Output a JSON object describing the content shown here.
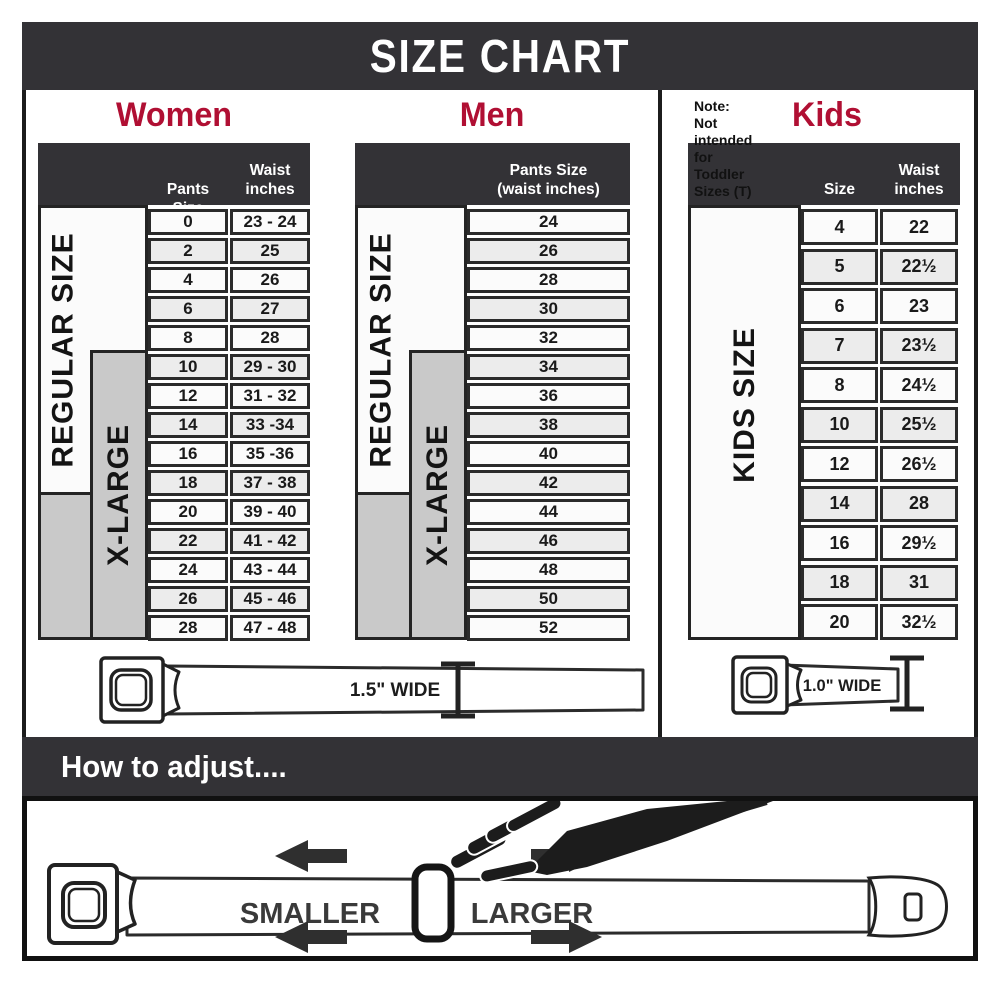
{
  "page": {
    "title": "SIZE CHART"
  },
  "colors": {
    "dark_band": "#333236",
    "accent_red": "#b00f33",
    "xlarge_gray": "#c9c9c9",
    "row_light": "#fbfbfb",
    "row_shaded": "#ececec",
    "border": "#2b2b2b"
  },
  "sections": {
    "women": {
      "title": "Women",
      "col1_header": "Pants Size",
      "col2_header_line1": "Waist",
      "col2_header_line2": "inches",
      "regular_label": "REGULAR SIZE",
      "xlarge_label": "X-LARGE",
      "rows": [
        {
          "size": "0",
          "waist": "23 - 24"
        },
        {
          "size": "2",
          "waist": "25"
        },
        {
          "size": "4",
          "waist": "26"
        },
        {
          "size": "6",
          "waist": "27"
        },
        {
          "size": "8",
          "waist": "28"
        },
        {
          "size": "10",
          "waist": "29 - 30"
        },
        {
          "size": "12",
          "waist": "31 - 32"
        },
        {
          "size": "14",
          "waist": "33 -34"
        },
        {
          "size": "16",
          "waist": "35 -36"
        },
        {
          "size": "18",
          "waist": "37 - 38"
        },
        {
          "size": "20",
          "waist": "39 - 40"
        },
        {
          "size": "22",
          "waist": "41 - 42"
        },
        {
          "size": "24",
          "waist": "43 - 44"
        },
        {
          "size": "26",
          "waist": "45 - 46"
        },
        {
          "size": "28",
          "waist": "47 - 48"
        }
      ]
    },
    "men": {
      "title": "Men",
      "col_header_line1": "Pants Size",
      "col_header_line2": "(waist inches)",
      "regular_label": "REGULAR SIZE",
      "xlarge_label": "X-LARGE",
      "rows": [
        "24",
        "26",
        "28",
        "30",
        "32",
        "34",
        "36",
        "38",
        "40",
        "42",
        "44",
        "46",
        "48",
        "50",
        "52"
      ]
    },
    "kids": {
      "title": "Kids",
      "col1_header": "Size",
      "col2_header_line1": "Waist",
      "col2_header_line2": "inches",
      "side_label": "KIDS SIZE",
      "note_line1": "Note:",
      "note_line2": "Not intended for",
      "note_line3": "Toddler Sizes (T)",
      "rows": [
        {
          "size": "4",
          "waist": "22"
        },
        {
          "size": "5",
          "waist": "22½"
        },
        {
          "size": "6",
          "waist": "23"
        },
        {
          "size": "7",
          "waist": "23½"
        },
        {
          "size": "8",
          "waist": "24½"
        },
        {
          "size": "10",
          "waist": "25½"
        },
        {
          "size": "12",
          "waist": "26½"
        },
        {
          "size": "14",
          "waist": "28"
        },
        {
          "size": "16",
          "waist": "29½"
        },
        {
          "size": "18",
          "waist": "31"
        },
        {
          "size": "20",
          "waist": "32½"
        }
      ]
    }
  },
  "belts": {
    "adult_width_label": "1.5\" WIDE",
    "kids_width_label": "1.0\" WIDE"
  },
  "adjust": {
    "title": "How to adjust....",
    "smaller_label": "SMALLER",
    "larger_label": "LARGER"
  }
}
